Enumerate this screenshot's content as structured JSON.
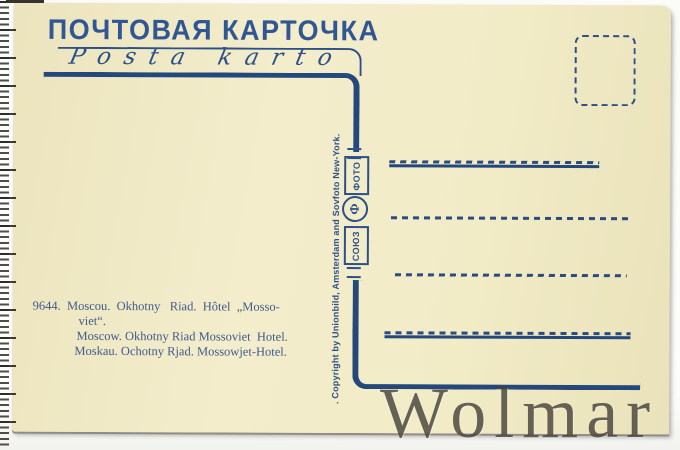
{
  "postcard": {
    "title_cyrillic": "ПОЧТОВАЯ КАРТОЧКА",
    "title_esperanto": "Posta karto",
    "publisher": {
      "word_top": "ФОТО",
      "word_bottom": "СОЮЗ",
      "emblem_letter": "Ф"
    },
    "copyright_line": ". Copyright by Unionbild, Amsterdam and Sovfoto New-York.",
    "caption": {
      "catalog_number": "9644",
      "lines": [
        "9644.  Moscou.  Okhotny   Riad.  Hôtel  „Mosso-",
        "viet“.",
        "Moscow. Okhotny Riad Mossoviet  Hotel.",
        "Moskau. Ochotny Rjad. Mossowjet-Hotel."
      ]
    },
    "watermark": "Wolmar",
    "address_line_count": 4,
    "colors": {
      "ink_blue": "#24477c",
      "paper_cream": "#f0eac6",
      "watermark_gray": "#3e3830"
    }
  }
}
